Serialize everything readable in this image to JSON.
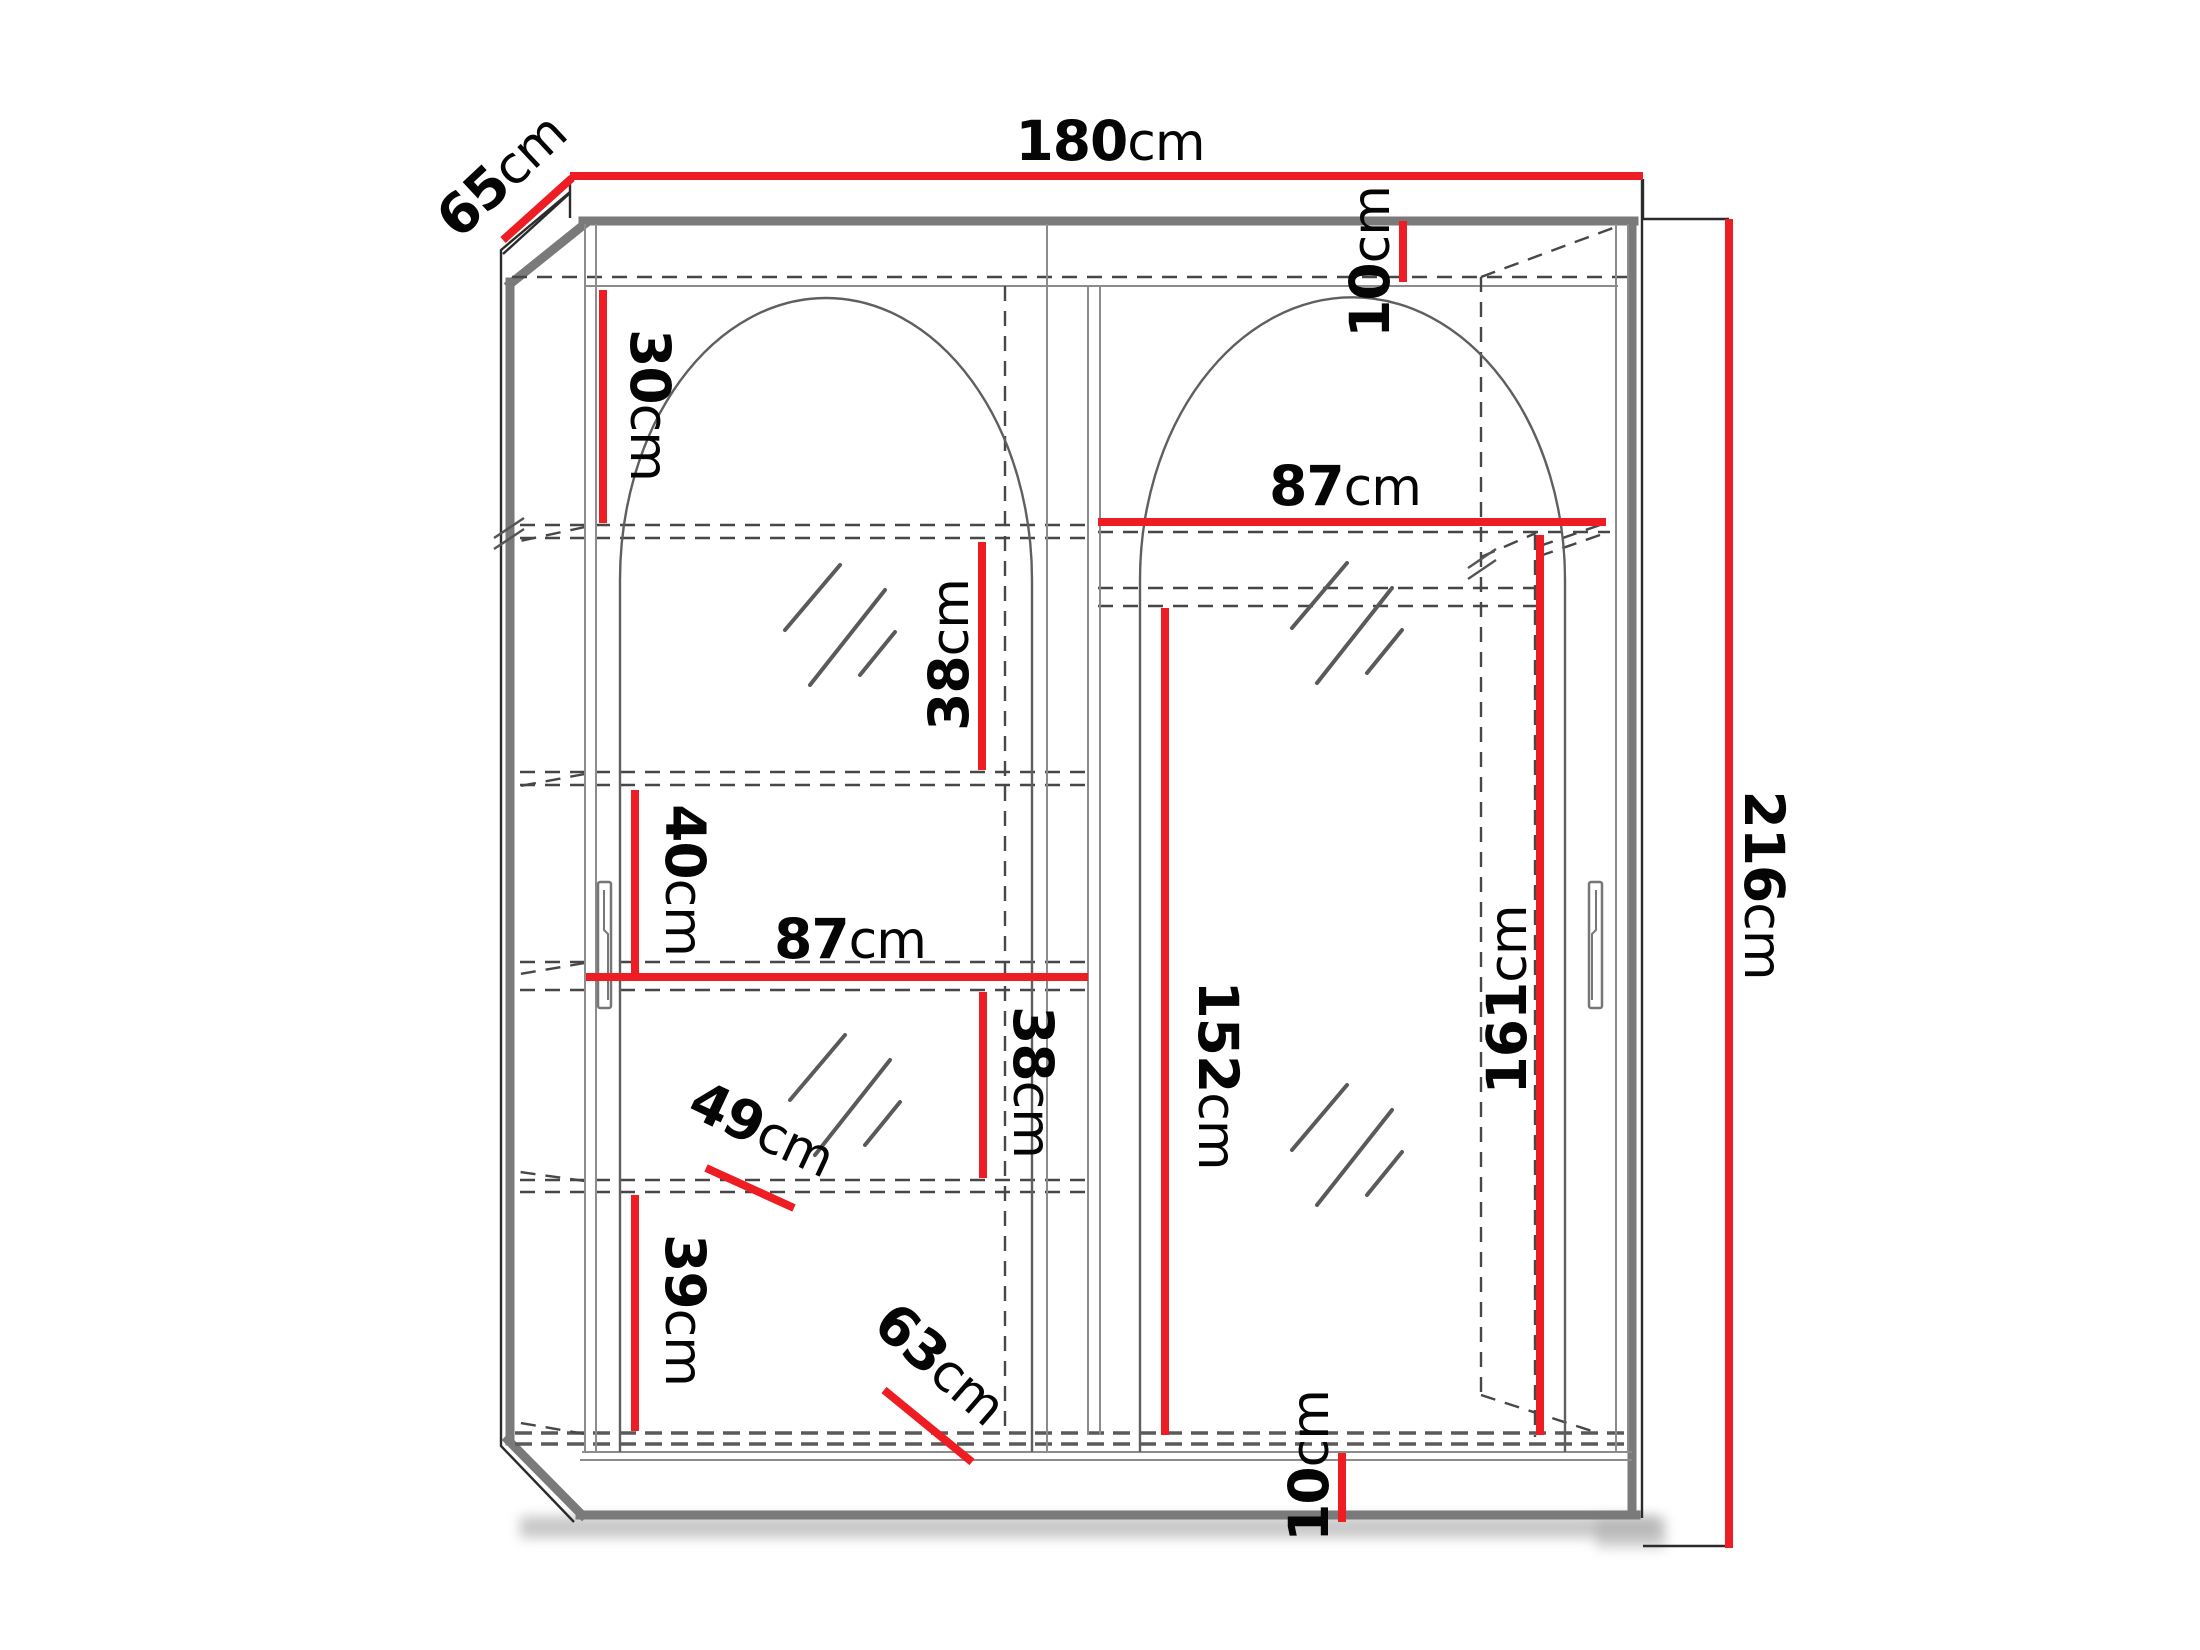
{
  "diagram": {
    "kind": "wardrobe-dimension-drawing",
    "description": "Two-door sliding wardrobe with arched mirror doors, shelves on left side and hanging space on right, annotated with red dimension lines",
    "accent_color": "#ee1c23",
    "edge_color": "#7a7a7a",
    "line_color": "#474747",
    "unit": "cm"
  },
  "dimensions": {
    "overall": {
      "width": {
        "num": "180",
        "unit": "cm"
      },
      "depth": {
        "num": "65",
        "unit": "cm"
      },
      "height": {
        "num": "216",
        "unit": "cm"
      }
    },
    "gaps": {
      "top": {
        "num": "10",
        "unit": "cm"
      },
      "bottom": {
        "num": "10",
        "unit": "cm"
      }
    },
    "left_column": {
      "top_section": {
        "num": "30",
        "unit": "cm"
      },
      "upper_section": {
        "num": "38",
        "unit": "cm"
      },
      "middle_section": {
        "num": "40",
        "unit": "cm"
      },
      "shelf_width": {
        "num": "87",
        "unit": "cm"
      },
      "lower_section": {
        "num": "38",
        "unit": "cm"
      },
      "bottom_section": {
        "num": "39",
        "unit": "cm"
      },
      "shelf_depth": {
        "num": "49",
        "unit": "cm"
      },
      "bottom_depth": {
        "num": "63",
        "unit": "cm"
      }
    },
    "right_column": {
      "shelf_width": {
        "num": "87",
        "unit": "cm"
      },
      "hanging_height": {
        "num": "152",
        "unit": "cm"
      },
      "interior_height": {
        "num": "161",
        "unit": "cm"
      }
    }
  }
}
